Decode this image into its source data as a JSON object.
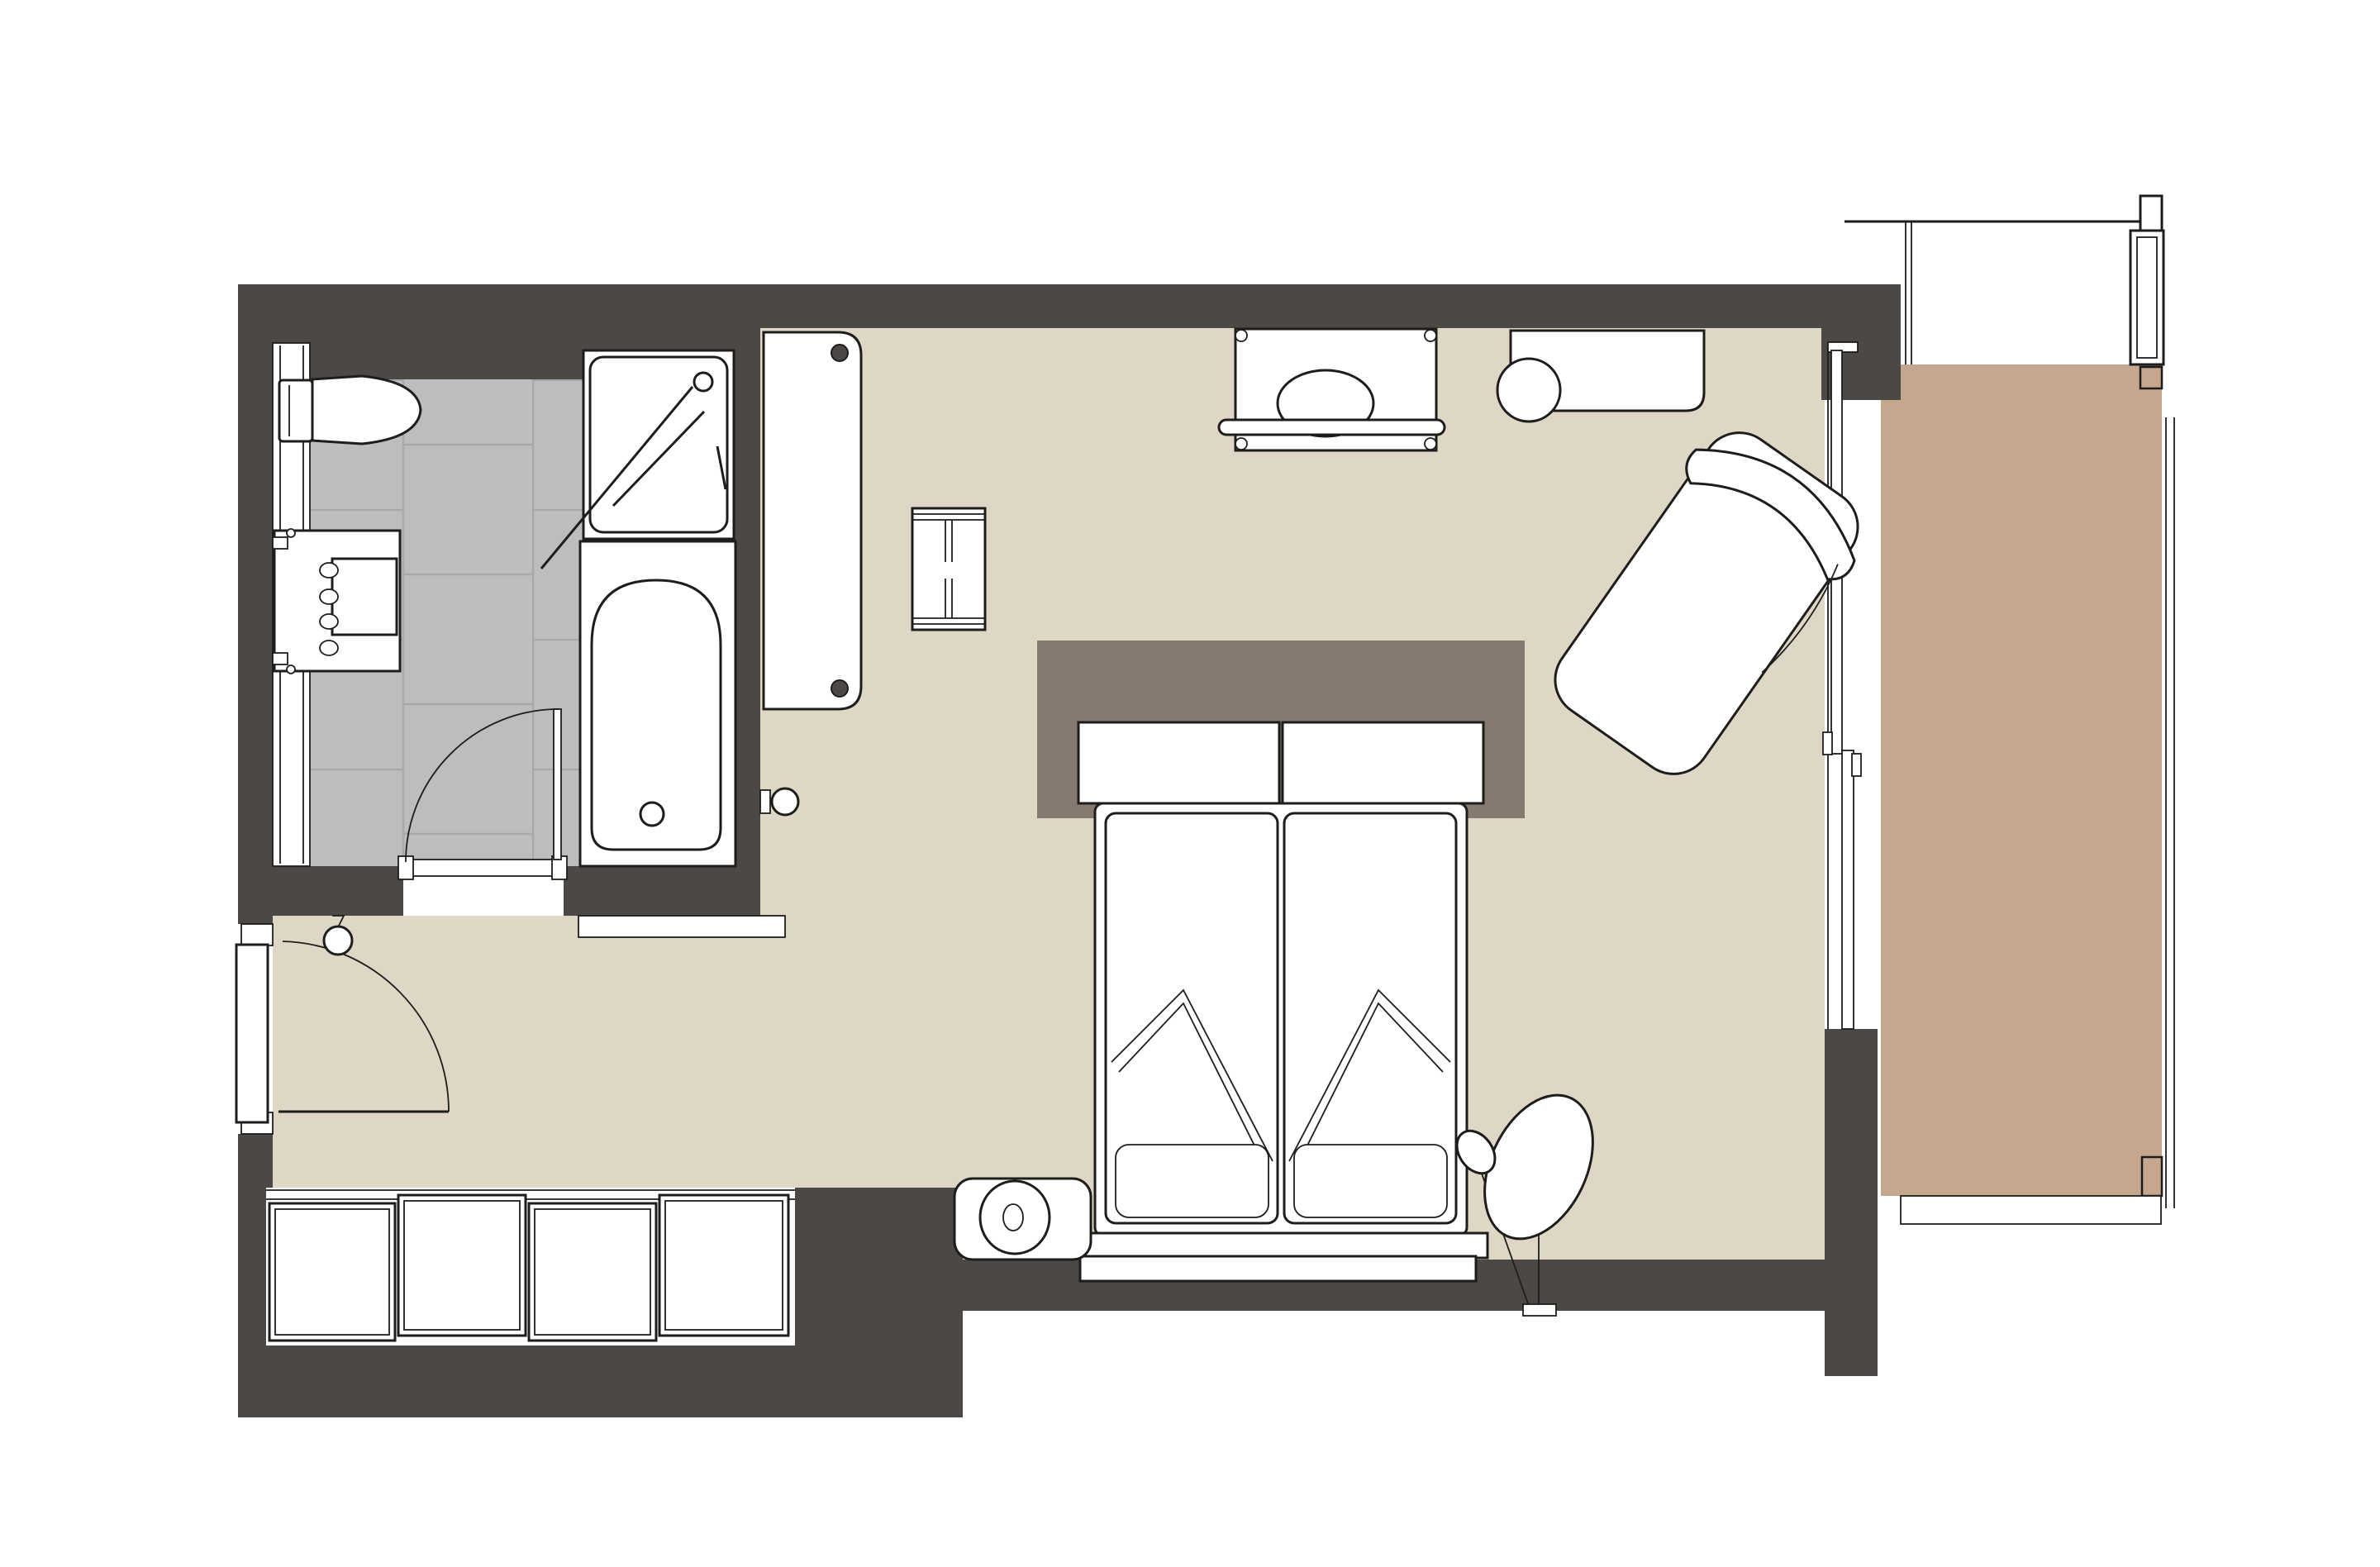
{
  "title": "Hotel guest room floor plan with bathroom, double bed, chaise lounge and balcony",
  "colors": {
    "paper": "#ffffff",
    "wall": "#4b4846",
    "outline": "#1d1d1b",
    "floor": "#ded7c5",
    "tile": "#bdbdbf",
    "grout": "#a8a8aa",
    "balcony": "#c4a78c",
    "headboard": "#867a70",
    "white": "#ffffff"
  },
  "rooms": [
    {
      "name": "bathroom",
      "floor_finish": "grey-tile"
    },
    {
      "name": "entry-vestibule",
      "floor_finish": "beige"
    },
    {
      "name": "bedroom",
      "floor_finish": "beige"
    },
    {
      "name": "balcony",
      "floor_finish": "tan-decking"
    }
  ],
  "fixtures": {
    "bathroom": [
      "wall-hung-toilet",
      "shower-enclosure",
      "shower-head-symbol",
      "bathtub",
      "bathtub-drain",
      "vanity-counter",
      "wash-basin",
      "tap-handles",
      "wall-niche-panel",
      "bathroom-door",
      "door-swing-arc"
    ],
    "entry": [
      "entry-door",
      "entry-door-swing-arc",
      "wall-knob"
    ],
    "bedroom": [
      "wardrobe",
      "luggage-rack",
      "console-table",
      "decor-bowl",
      "towel-rail",
      "desk",
      "desk-chair",
      "chaise-lounge",
      "headboard-wall-panel",
      "headboard-cushions",
      "double-bed",
      "mattress-left",
      "mattress-right",
      "duvet-fold-left",
      "duvet-fold-right",
      "foot-throw-left",
      "foot-throw-right",
      "foot-bench",
      "pouf-stool",
      "floor-lamp",
      "built-in-closet-sliding-doors",
      "wall-hook-knob"
    ],
    "balcony": [
      "sliding-glass-door",
      "door-handles",
      "privacy-screen",
      "screen-column",
      "railing",
      "railing-base"
    ]
  }
}
